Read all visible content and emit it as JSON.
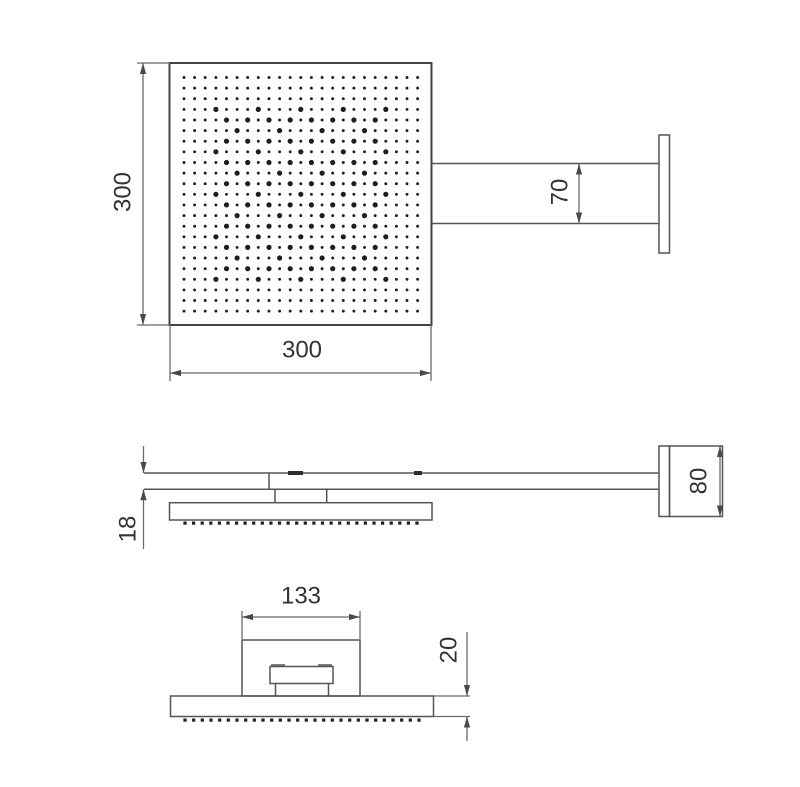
{
  "drawing": {
    "kind": "technical-drawing",
    "subject": "square rain shower head with wall-mount arm, three orthographic views",
    "colors": {
      "object_line": "#424242",
      "dimension_line": "#6b6b6b",
      "text": "#333333",
      "nozzle_dot": "#1e1e1e",
      "background": "#ffffff"
    },
    "dimensions": {
      "head_height": "300",
      "head_width": "300",
      "arm_width": "70",
      "arm_thickness": "18",
      "wall_plate_height": "80",
      "bracket_width": "133",
      "plate_thickness": "20"
    },
    "spray_pattern": {
      "rows": 23,
      "cols": 23,
      "bold_motif": "diamond-x-lattice"
    }
  }
}
